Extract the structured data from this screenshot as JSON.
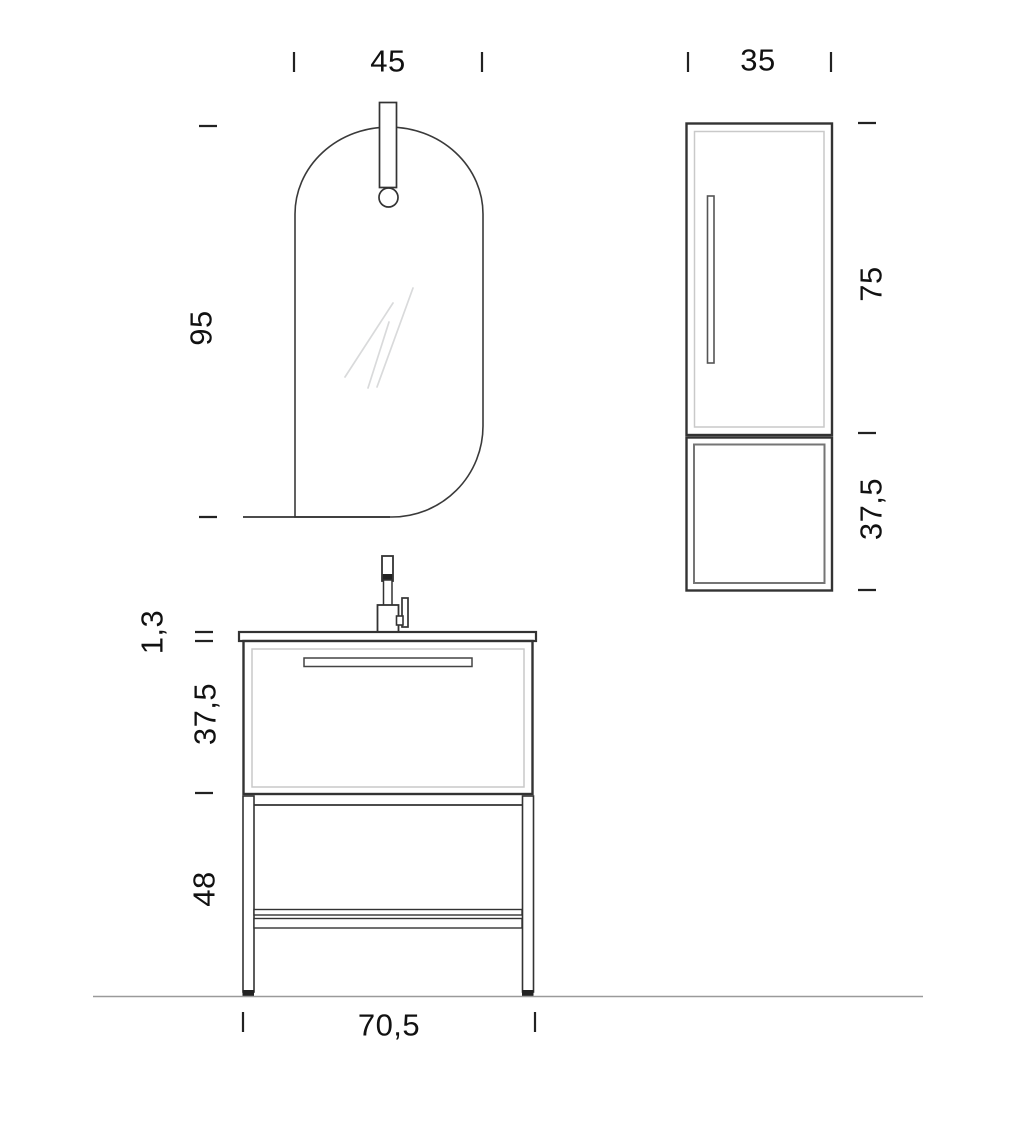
{
  "dimensions": {
    "mirror": {
      "width": "45",
      "height": "95"
    },
    "tall_cabinet": {
      "width": "35",
      "upper_height": "75",
      "lower_height": "37,5"
    },
    "vanity": {
      "top_thickness": "1,3",
      "basin_unit_height": "37,5",
      "leg_height": "48",
      "width": "70,5"
    }
  },
  "colors": {
    "line": "#333333",
    "inner_line": "#c9c9c9",
    "open_box_line": "#757575",
    "floor_line": "#9a9a9a",
    "reflection_line": "#d9dadb",
    "text": "#111111"
  }
}
